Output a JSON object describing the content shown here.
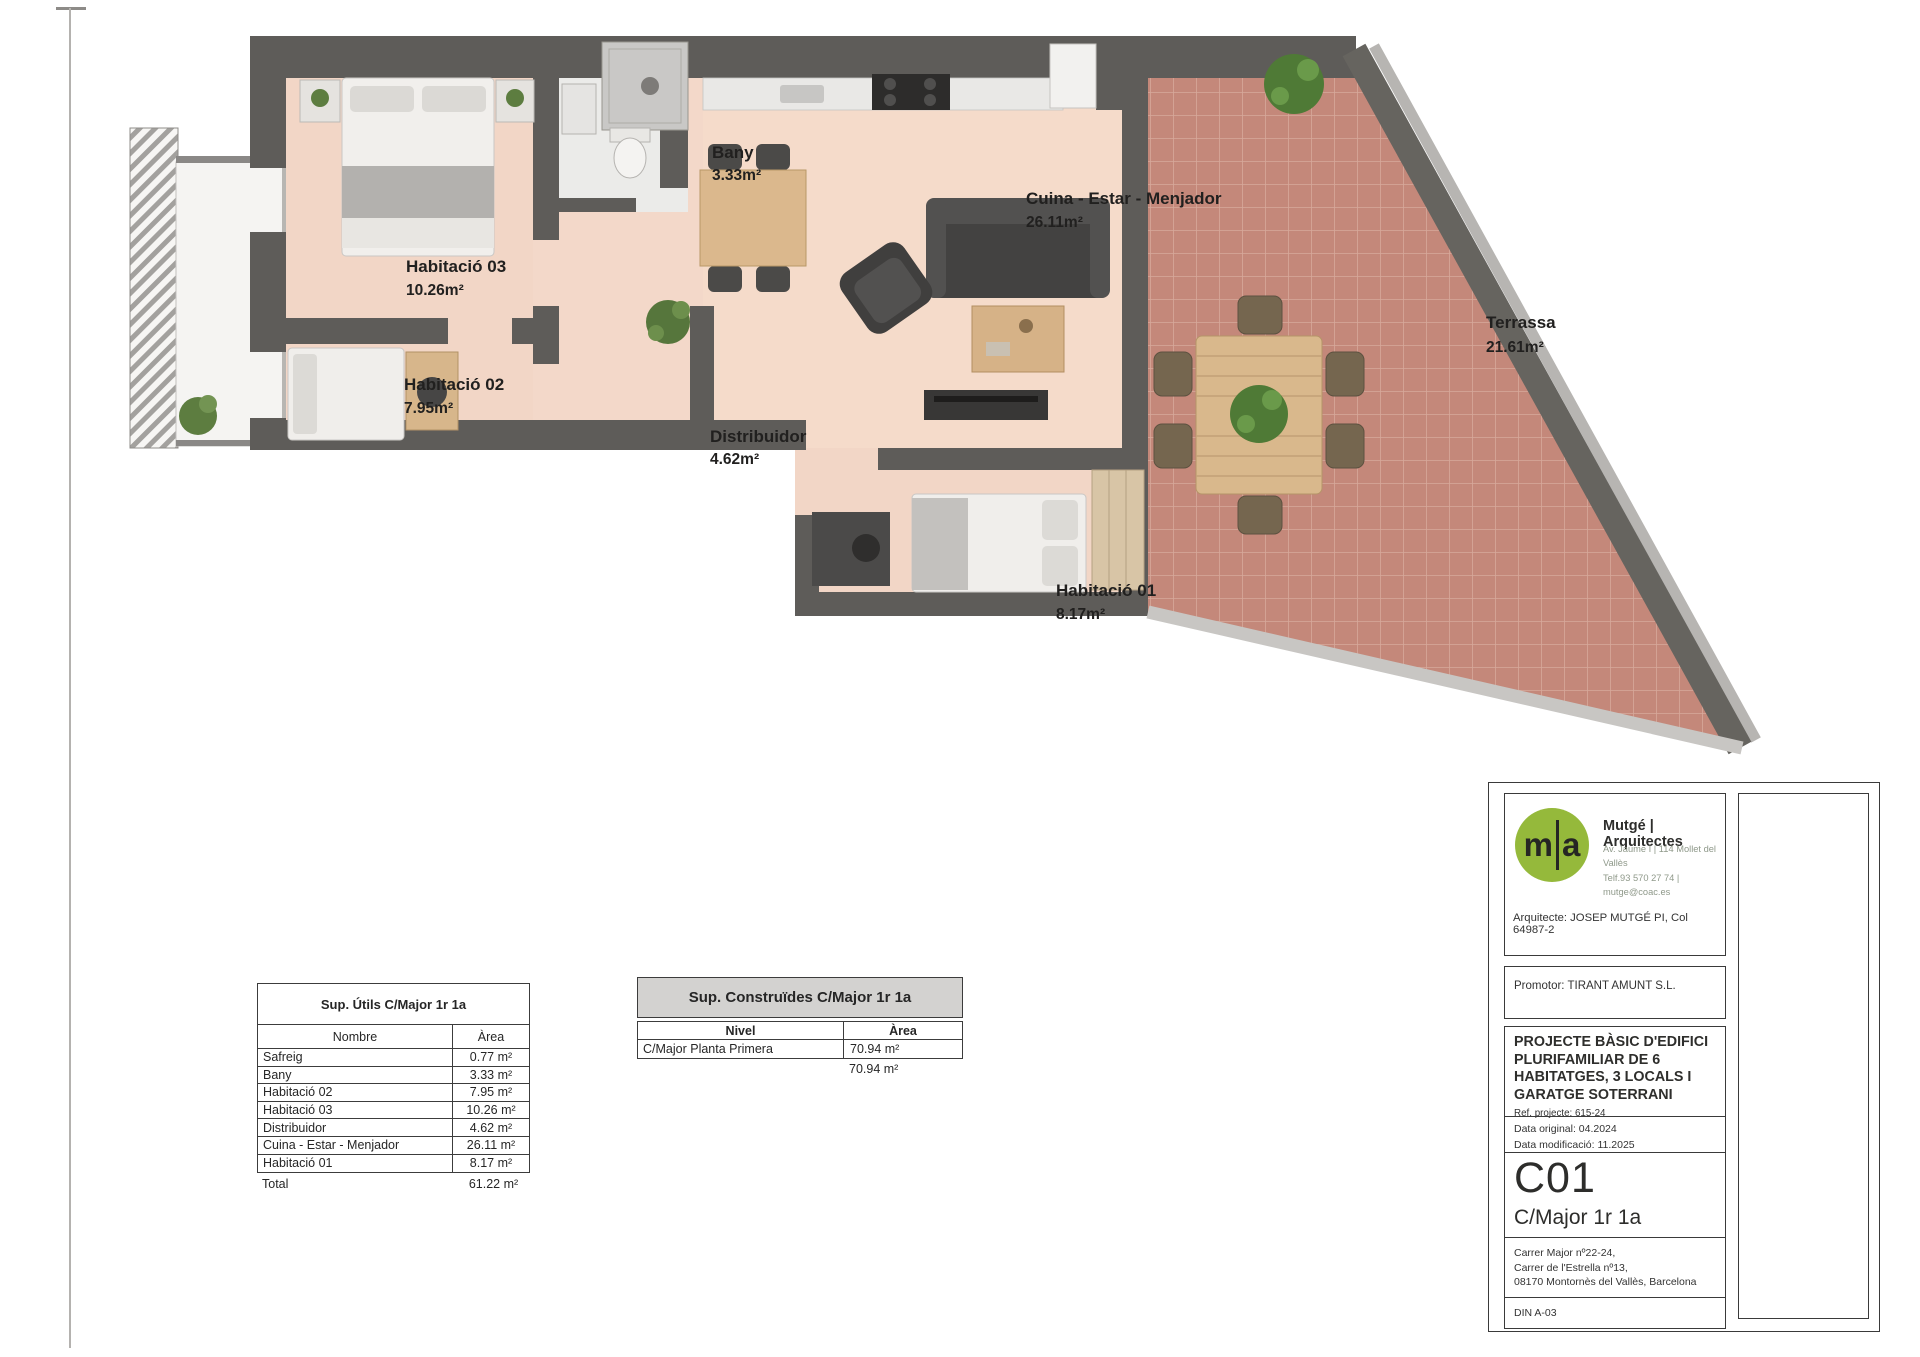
{
  "plan": {
    "labels": {
      "habitacio03": {
        "name": "Habitació 03",
        "area": "10.26m²"
      },
      "habitacio02": {
        "name": "Habitació 02",
        "area": "7.95m²"
      },
      "bany": {
        "name": "Bany",
        "area": "3.33m²"
      },
      "distribuidor": {
        "name": "Distribuidor",
        "area": "4.62m²"
      },
      "cuina_estar_menjador": {
        "name": "Cuina - Estar - Menjador",
        "area": "26.11m²"
      },
      "habitacio01": {
        "name": "Habitació 01",
        "area": "8.17m²"
      },
      "terrassa": {
        "name": "Terrassa",
        "area": "21.61m²"
      }
    },
    "colors": {
      "wall": "#5e5c59",
      "floor": "#f2d6c6",
      "terrace": "#c4887a",
      "bath_floor": "#ebebe9"
    }
  },
  "tables": {
    "utils": {
      "title": "Sup. Útils C/Major 1r 1a",
      "col_name": "Nombre",
      "col_area": "Àrea",
      "rows": [
        {
          "name": "Safreig",
          "area": "0.77 m²"
        },
        {
          "name": "Bany",
          "area": "3.33 m²"
        },
        {
          "name": "Habitació 02",
          "area": "7.95 m²"
        },
        {
          "name": "Habitació 03",
          "area": "10.26 m²"
        },
        {
          "name": "Distribuidor",
          "area": "4.62 m²"
        },
        {
          "name": "Cuina - Estar - Menjador",
          "area": "26.11 m²"
        },
        {
          "name": "Habitació 01",
          "area": "8.17 m²"
        }
      ],
      "total_label": "Total",
      "total_value": "61.22 m²"
    },
    "construides": {
      "title": "Sup. Construïdes C/Major 1r 1a",
      "col_level": "Nivel",
      "col_area": "Àrea",
      "rows": [
        {
          "level": "C/Major Planta Primera",
          "area": "70.94 m²"
        }
      ],
      "total_value": "70.94 m²"
    }
  },
  "titleblock": {
    "logo_m": "m",
    "logo_a": "a",
    "firm": "Mutgé | Arquitectes",
    "contact_line1": "Av. Jaume I | 114 Mollet del Vallès",
    "contact_line2": "Telf.93 570 27 74 | mutge@coac.es",
    "architect": "Arquitecte: JOSEP MUTGÉ PI, Col 64987-2",
    "promoter": "Promotor: TIRANT AMUNT S.L.",
    "project_title": "PROJECTE BÀSIC D'EDIFICI PLURIFAMILIAR DE 6 HABITATGES, 3 LOCALS I GARATGE SOTERRANI",
    "project_ref": "Ref. projecte: 615-24",
    "date_original": "Data original: 04.2024",
    "date_modified": "Data modificació: 11.2025",
    "sheet_code": "C01",
    "sheet_name": "C/Major 1r 1a",
    "site_line1": "Carrer Major nº22-24,",
    "site_line2": "Carrer de l'Estrella nº13,",
    "site_line3": "08170 Montornès del Vallès, Barcelona",
    "paper_size": "DIN A-03"
  }
}
